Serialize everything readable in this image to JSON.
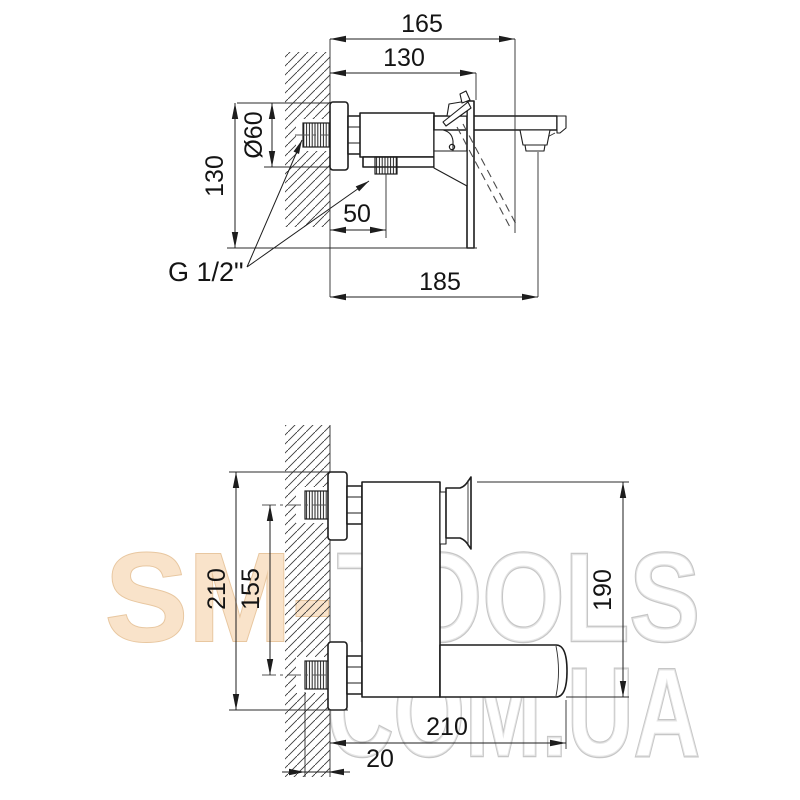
{
  "drawing": {
    "top_view": {
      "dim_overall_depth": "165",
      "dim_body_depth": "130",
      "dim_flange_diameter": "Ø60",
      "dim_height": "130",
      "dim_outlet_offset": "50",
      "dim_spout_depth": "185",
      "thread_label": "G 1/2\""
    },
    "front_view": {
      "dim_overall_height": "210",
      "dim_port_spacing": "155",
      "dim_body_height": "190",
      "dim_spout_reach": "210",
      "dim_wall_offset": "20"
    }
  },
  "watermark": {
    "part_sm": "SM-",
    "part_tools": "TOOLS",
    "line2": "COM.UA"
  }
}
